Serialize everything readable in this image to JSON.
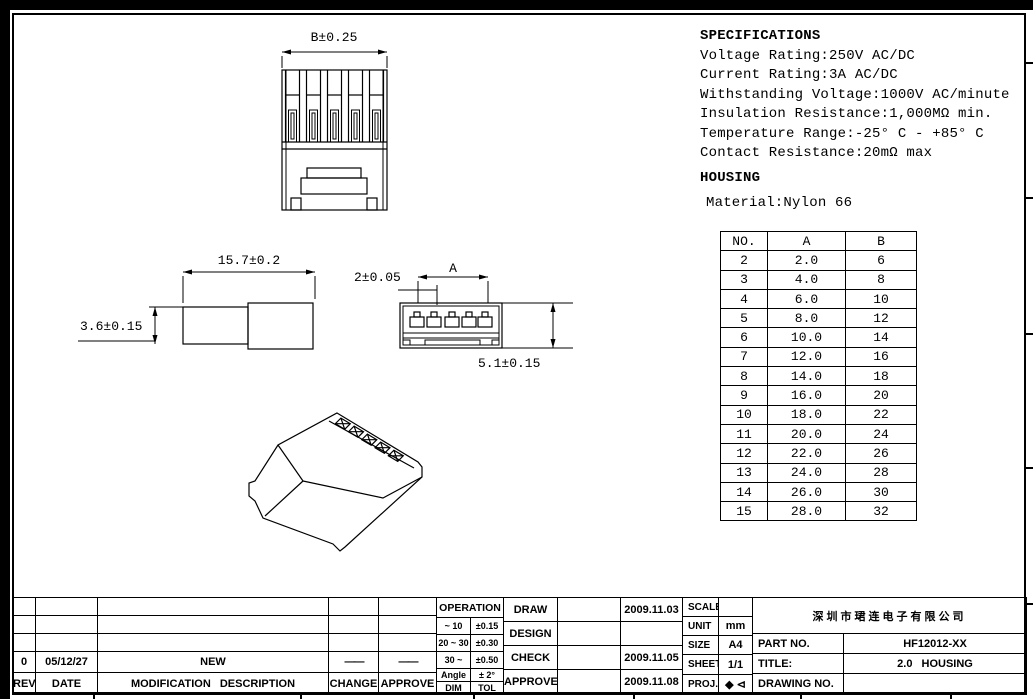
{
  "specifications": {
    "title": "SPECIFICATIONS",
    "lines": [
      "Voltage Rating:250V AC/DC",
      "Current Rating:3A AC/DC",
      "Withstanding Voltage:1000V AC/minute",
      "Insulation Resistance:1,000MΩ min.",
      "Temperature Range:-25° C - +85° C",
      "Contact Resistance:20mΩ max"
    ],
    "housing_title": "HOUSING",
    "material_line": "Material:Nylon 66"
  },
  "size_table": {
    "headers": [
      "NO.",
      "A",
      "B"
    ],
    "rows": [
      [
        "2",
        "2.0",
        "6"
      ],
      [
        "3",
        "4.0",
        "8"
      ],
      [
        "4",
        "6.0",
        "10"
      ],
      [
        "5",
        "8.0",
        "12"
      ],
      [
        "6",
        "10.0",
        "14"
      ],
      [
        "7",
        "12.0",
        "16"
      ],
      [
        "8",
        "14.0",
        "18"
      ],
      [
        "9",
        "16.0",
        "20"
      ],
      [
        "10",
        "18.0",
        "22"
      ],
      [
        "11",
        "20.0",
        "24"
      ],
      [
        "12",
        "22.0",
        "26"
      ],
      [
        "13",
        "24.0",
        "28"
      ],
      [
        "14",
        "26.0",
        "30"
      ],
      [
        "15",
        "28.0",
        "32"
      ]
    ]
  },
  "dimensions": {
    "top_view_width": "B±0.25",
    "side_view_length": "15.7±0.2",
    "side_view_height": "3.6±0.15",
    "front_view_pitch": "2±0.05",
    "front_view_span": "A",
    "front_view_height": "5.1±0.15"
  },
  "revision_table": {
    "rev_header": "REV",
    "date_header": "DATE",
    "desc_header": "MODIFICATION DESCRIPTION",
    "change_header": "CHANGE",
    "approve_header": "APPROVE",
    "rows": [
      {
        "rev": "0",
        "date": "05/12/27",
        "description": "NEW",
        "change": "——",
        "approve": "——"
      }
    ]
  },
  "tolerance_table": {
    "title": "OPERATION",
    "rows": [
      [
        "~ 10",
        "±0.15"
      ],
      [
        "20 ~ 30",
        "±0.30"
      ],
      [
        "30 ~",
        "±0.50"
      ],
      [
        "Angle",
        "± 2°"
      ]
    ],
    "footer": [
      "DIM",
      "TOL"
    ]
  },
  "approval_table": {
    "rows": [
      {
        "label": "DRAW",
        "name": "",
        "date": "2009.11.03"
      },
      {
        "label": "DESIGN",
        "name": "",
        "date": ""
      },
      {
        "label": "CHECK",
        "name": "",
        "date": "2009.11.05"
      },
      {
        "label": "APPROVE",
        "name": "",
        "date": "2009.11.08"
      }
    ]
  },
  "info_table": {
    "scale_label": "SCALE",
    "scale_value": "",
    "unit_label": "UNIT",
    "unit_value": "mm",
    "size_label": "SIZE",
    "size_value": "A4",
    "sheet_label": "SHEET",
    "sheet_value": "1/1",
    "proj_label": "PROJ.",
    "proj_symbol": "◆ ⊲"
  },
  "title_block": {
    "company": "深圳市珺连电子有限公司",
    "part_no_label": "PART NO.",
    "part_no": "HF12012-XX",
    "title_label": "TITLE:",
    "title": "2.0 HOUSING",
    "drawing_no_label": "DRAWING NO.",
    "drawing_no": ""
  }
}
